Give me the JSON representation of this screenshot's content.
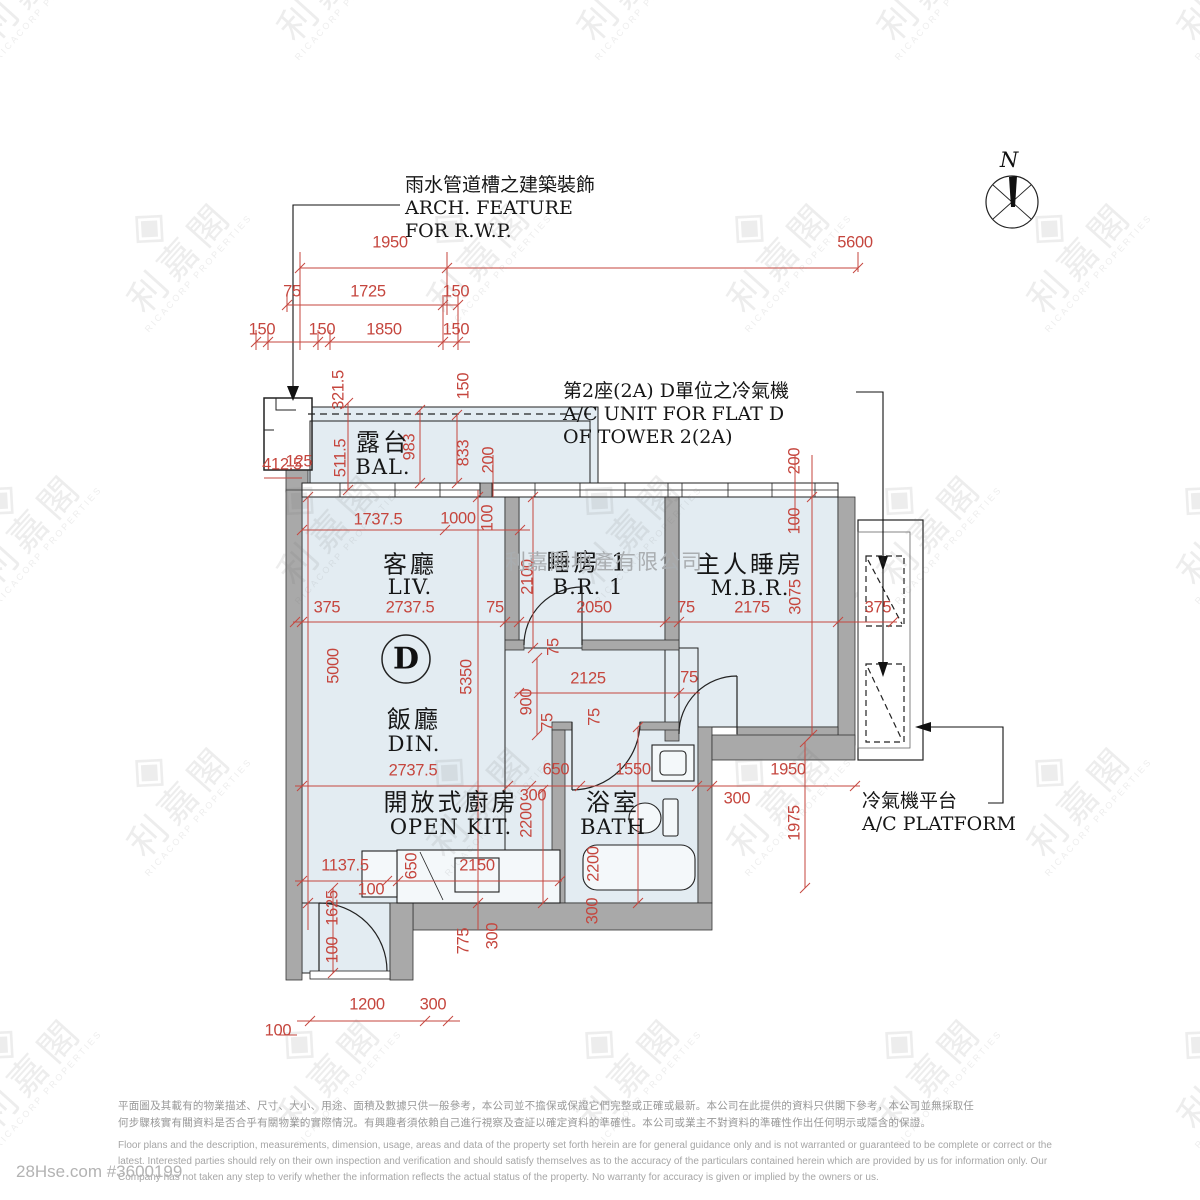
{
  "page": {
    "credit": "28Hse.com #3600199"
  },
  "watermark": {
    "brand_cn": "利嘉閣",
    "brand_en": "RICACORP PROPERTIES",
    "logo_glyph": "◈",
    "company": "利嘉閣地產有限公司",
    "site_large": "28Hse.com"
  },
  "plan": {
    "unit_label": "D",
    "north_label": "N",
    "annotations": [
      {
        "id": "rwp",
        "x": 405,
        "y": 174,
        "lines": [
          "雨水管道槽之建築裝飾",
          "ARCH.  FEATURE",
          "FOR  R.W.P."
        ]
      },
      {
        "id": "ac-unit",
        "x": 563,
        "y": 380,
        "lines": [
          "第2座(2A)  D單位之冷氣機",
          "A/C  UNIT  FOR  FLAT  D",
          "OF  TOWER  2(2A)"
        ]
      },
      {
        "id": "ac-platform",
        "x": 862,
        "y": 790,
        "lines": [
          "冷氣機平台",
          "A/C  PLATFORM"
        ]
      }
    ],
    "rooms": [
      {
        "id": "balcony",
        "cn": "露台",
        "en": "BAL.",
        "x": 383,
        "cy": 440,
        "ey": 467
      },
      {
        "id": "living",
        "cn": "客廳",
        "en": "LIV.",
        "x": 410,
        "cy": 562,
        "ey": 587
      },
      {
        "id": "bedroom1",
        "cn": "睡房 1",
        "en": "B.R.  1",
        "x": 588,
        "cy": 560,
        "ey": 587
      },
      {
        "id": "master-bedroom",
        "cn": "主人睡房",
        "en": "M.B.R.",
        "x": 750,
        "cy": 562,
        "ey": 588
      },
      {
        "id": "dining",
        "cn": "飯廳",
        "en": "DIN.",
        "x": 414,
        "cy": 717,
        "ey": 744
      },
      {
        "id": "open-kitchen",
        "cn": "開放式廚房",
        "en": "OPEN KIT.",
        "x": 451,
        "cy": 800,
        "ey": 827
      },
      {
        "id": "bathroom",
        "cn": "浴室",
        "en": "BATH",
        "x": 613,
        "cy": 800,
        "ey": 827
      }
    ],
    "dimensions": [
      {
        "t": "1950",
        "x": 390,
        "y": 243
      },
      {
        "t": "5600",
        "x": 855,
        "y": 243
      },
      {
        "t": "75",
        "x": 292,
        "y": 292
      },
      {
        "t": "1725",
        "x": 368,
        "y": 292
      },
      {
        "t": "150",
        "x": 456,
        "y": 292
      },
      {
        "t": "150",
        "x": 262,
        "y": 330
      },
      {
        "t": "150",
        "x": 322,
        "y": 330
      },
      {
        "t": "1850",
        "x": 384,
        "y": 330
      },
      {
        "t": "150",
        "x": 456,
        "y": 330
      },
      {
        "t": "321.5",
        "x": 339,
        "y": 390,
        "v": 1
      },
      {
        "t": "150",
        "x": 464,
        "y": 386,
        "v": 1
      },
      {
        "t": "125",
        "x": 299,
        "y": 462
      },
      {
        "t": "511.5",
        "x": 341,
        "y": 458,
        "v": 1
      },
      {
        "t": "983",
        "x": 410,
        "y": 447,
        "v": 1
      },
      {
        "t": "833",
        "x": 464,
        "y": 453,
        "v": 1
      },
      {
        "t": "200",
        "x": 489,
        "y": 460,
        "v": 1
      },
      {
        "t": "412.5",
        "x": 282,
        "y": 465
      },
      {
        "t": "1737.5",
        "x": 378,
        "y": 520
      },
      {
        "t": "1000",
        "x": 458,
        "y": 519
      },
      {
        "t": "100",
        "x": 488,
        "y": 518,
        "v": 1
      },
      {
        "t": "200",
        "x": 795,
        "y": 461,
        "v": 1
      },
      {
        "t": "100",
        "x": 795,
        "y": 521,
        "v": 1
      },
      {
        "t": "375",
        "x": 327,
        "y": 608
      },
      {
        "t": "2737.5",
        "x": 410,
        "y": 608
      },
      {
        "t": "75",
        "x": 495,
        "y": 608
      },
      {
        "t": "2100",
        "x": 528,
        "y": 577,
        "v": 1
      },
      {
        "t": "2050",
        "x": 594,
        "y": 608
      },
      {
        "t": "75",
        "x": 686,
        "y": 608
      },
      {
        "t": "2175",
        "x": 752,
        "y": 608
      },
      {
        "t": "3075",
        "x": 796,
        "y": 597,
        "v": 1
      },
      {
        "t": "375",
        "x": 878,
        "y": 608
      },
      {
        "t": "5000",
        "x": 334,
        "y": 666,
        "v": 1
      },
      {
        "t": "5350",
        "x": 467,
        "y": 677,
        "v": 1
      },
      {
        "t": "2125",
        "x": 588,
        "y": 679
      },
      {
        "t": "75",
        "x": 689,
        "y": 678
      },
      {
        "t": "75",
        "x": 554,
        "y": 647,
        "v": 1
      },
      {
        "t": "900",
        "x": 527,
        "y": 702,
        "v": 1
      },
      {
        "t": "75",
        "x": 548,
        "y": 722,
        "v": 1
      },
      {
        "t": "75",
        "x": 595,
        "y": 717,
        "v": 1
      },
      {
        "t": "2737.5",
        "x": 413,
        "y": 771
      },
      {
        "t": "650",
        "x": 556,
        "y": 770
      },
      {
        "t": "1550",
        "x": 633,
        "y": 770
      },
      {
        "t": "300",
        "x": 533,
        "y": 796
      },
      {
        "t": "1950",
        "x": 788,
        "y": 770
      },
      {
        "t": "300",
        "x": 737,
        "y": 799
      },
      {
        "t": "1975",
        "x": 795,
        "y": 823,
        "v": 1
      },
      {
        "t": "2200",
        "x": 527,
        "y": 820,
        "v": 1
      },
      {
        "t": "2200",
        "x": 594,
        "y": 864,
        "v": 1
      },
      {
        "t": "1137.5",
        "x": 345,
        "y": 866
      },
      {
        "t": "100",
        "x": 371,
        "y": 890
      },
      {
        "t": "650",
        "x": 412,
        "y": 866,
        "v": 1
      },
      {
        "t": "2150",
        "x": 477,
        "y": 866
      },
      {
        "t": "775",
        "x": 464,
        "y": 941,
        "v": 1
      },
      {
        "t": "300",
        "x": 493,
        "y": 936,
        "v": 1
      },
      {
        "t": "300",
        "x": 593,
        "y": 911,
        "v": 1
      },
      {
        "t": "1625",
        "x": 333,
        "y": 908,
        "v": 1
      },
      {
        "t": "100",
        "x": 333,
        "y": 950,
        "v": 1
      },
      {
        "t": "1200",
        "x": 367,
        "y": 1005
      },
      {
        "t": "300",
        "x": 433,
        "y": 1005
      },
      {
        "t": "100",
        "x": 278,
        "y": 1031
      }
    ]
  },
  "disclaimer": {
    "cn": [
      "平面圖及其載有的物業描述、尺寸、大小、用途、面積及數據只供一般參考，本公司並不擔保或保證它們完整或正確或最新。本公司在此提供的資料只供閣下參考，本公司並無採取任",
      "何步驟核實有關資料是否合乎有關物業的實際情況。有興趣者須依賴自己進行視察及查証以確定資料的準確性。本公司或業主不對資料的準確性作出任何明示或隱含的保證。"
    ],
    "en": [
      "Floor plans and the description, measurements, dimension, usage, areas and data of the property set forth herein are for general guidance only and is not warranted or guaranteed to be complete or correct or the",
      "latest.  Interested parties should rely on their own inspection and verification and should satisfy themselves as to the accuracy of the particulars contained herein which are provided by us for information only.  Our",
      "Company has not taken any step to verify whether the information reflects the actual status of the property.  No warranty for accuracy is given or implied by the owners or us."
    ]
  }
}
